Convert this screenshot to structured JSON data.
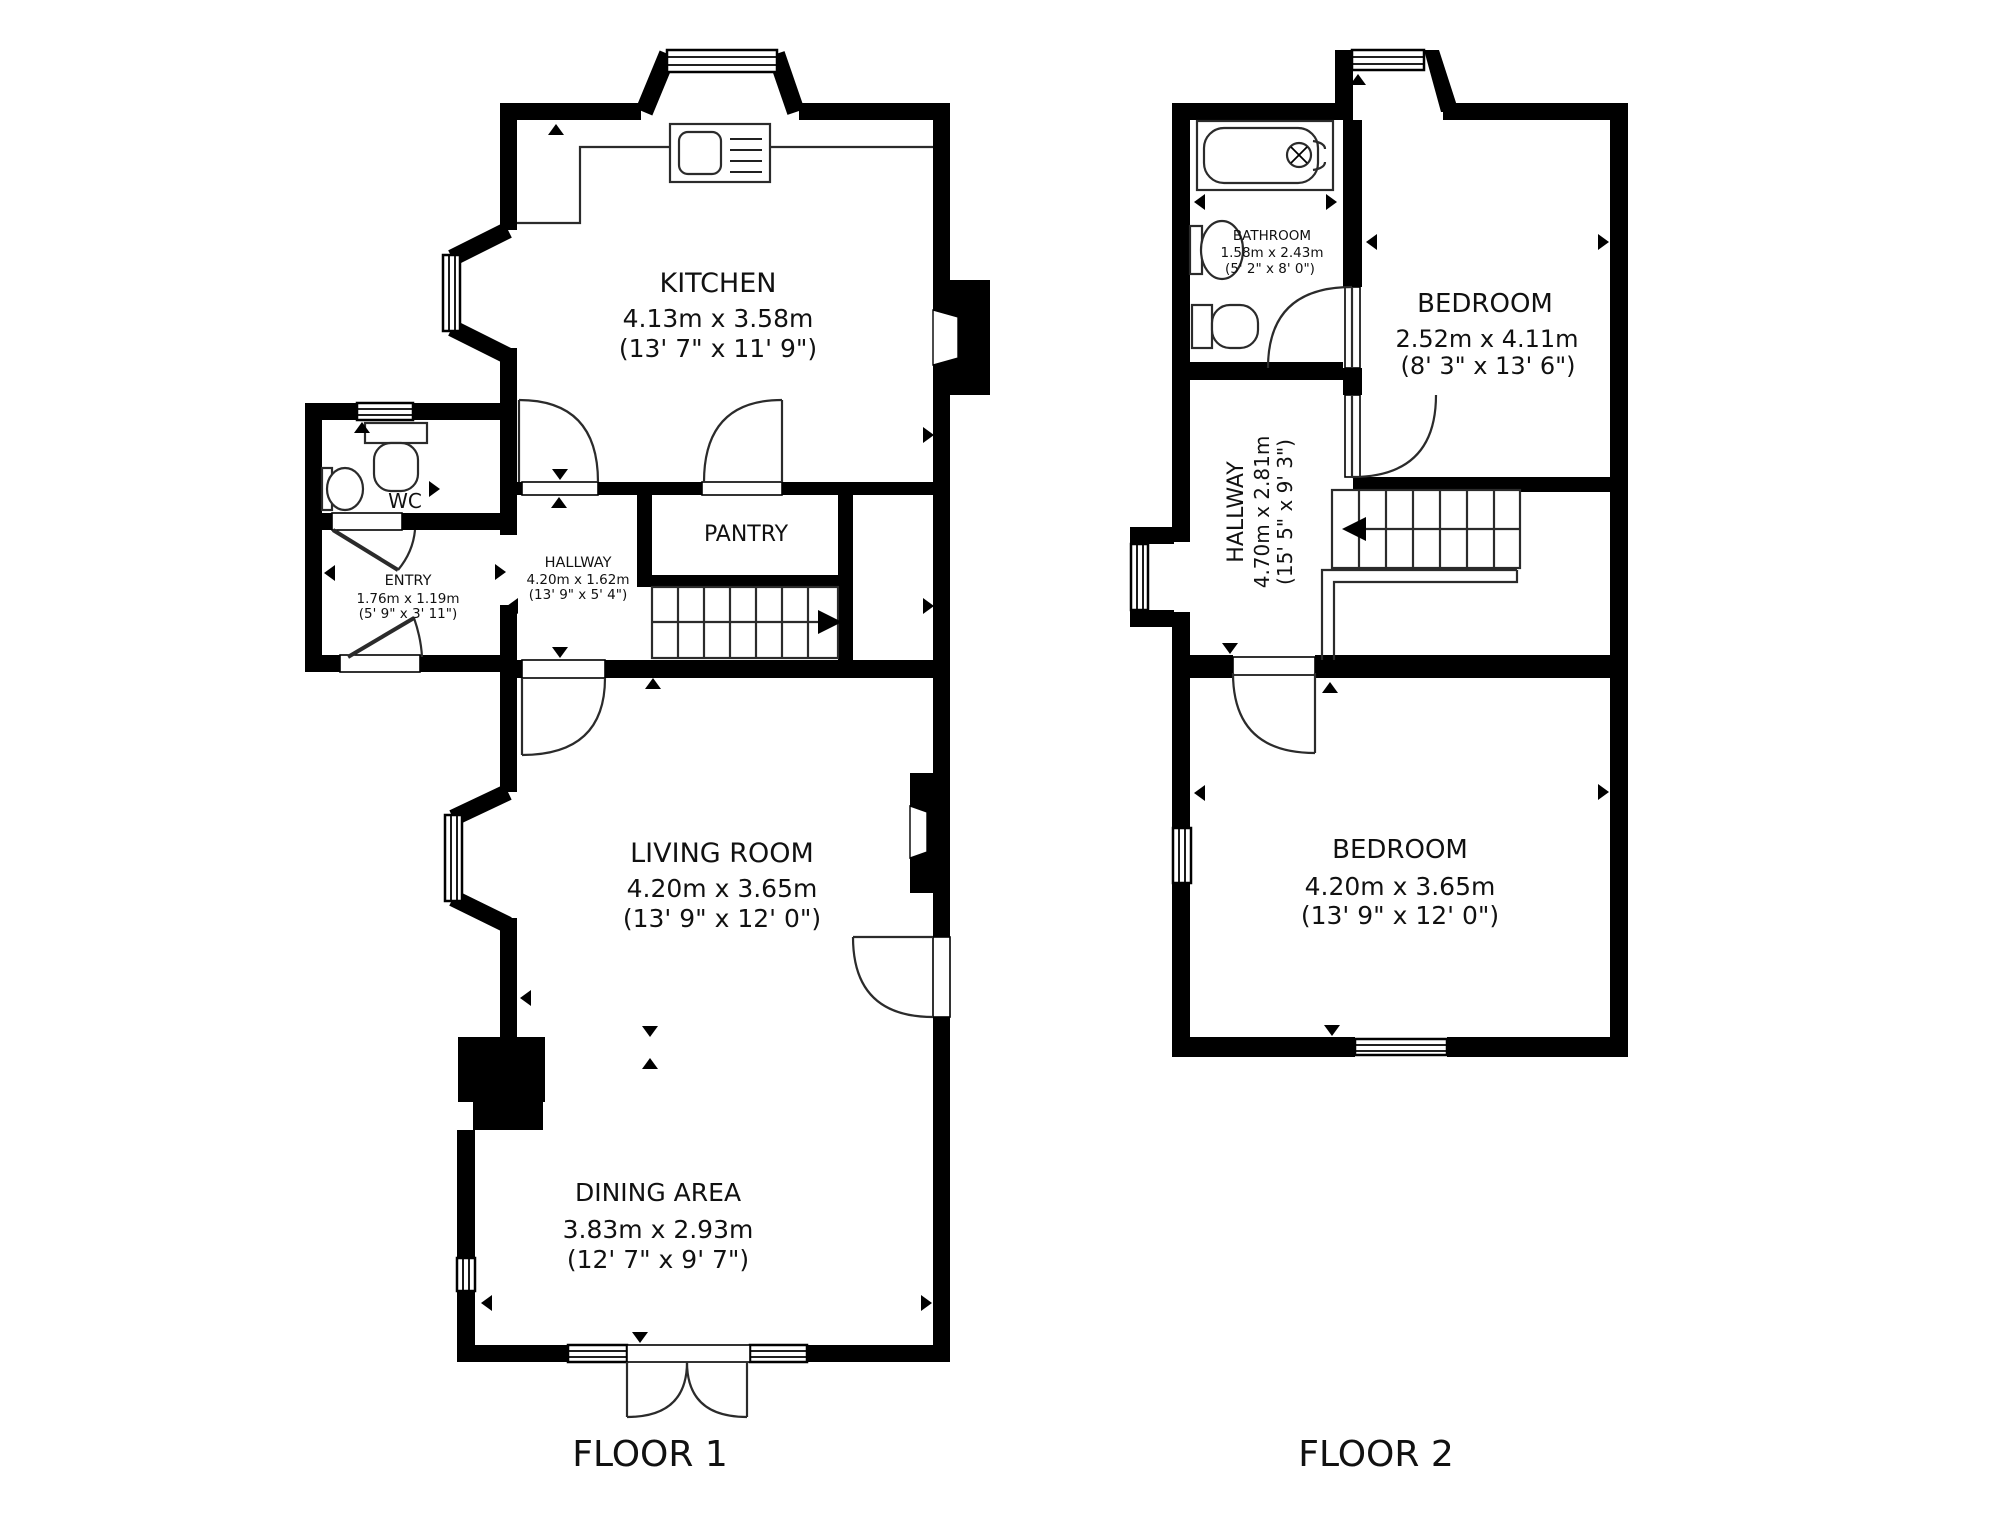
{
  "colors": {
    "wall": "#000000",
    "line": "#2b2b2b",
    "text": "#111111",
    "background": "#ffffff"
  },
  "floor1": {
    "caption": "FLOOR 1",
    "rooms": {
      "kitchen": {
        "name": "KITCHEN",
        "metric": "4.13m x 3.58m",
        "imperial": "(13' 7\" x 11' 9\")"
      },
      "wc": {
        "name": "WC"
      },
      "entry": {
        "name": "ENTRY",
        "metric": "1.76m x 1.19m",
        "imperial": "(5' 9\" x 3' 11\")"
      },
      "hallway": {
        "name": "HALLWAY",
        "metric": "4.20m x 1.62m",
        "imperial": "(13' 9\" x 5' 4\")"
      },
      "pantry": {
        "name": "PANTRY"
      },
      "living": {
        "name": "LIVING ROOM",
        "metric": "4.20m x 3.65m",
        "imperial": "(13' 9\" x 12' 0\")"
      },
      "dining": {
        "name": "DINING AREA",
        "metric": "3.83m x 2.93m",
        "imperial": "(12' 7\" x 9' 7\")"
      }
    }
  },
  "floor2": {
    "caption": "FLOOR 2",
    "rooms": {
      "bathroom": {
        "name": "BATHROOM",
        "metric": "1.58m x 2.43m",
        "imperial": "(5' 2\" x 8' 0\")"
      },
      "bedroom1": {
        "name": "BEDROOM",
        "metric": "2.52m x 4.11m",
        "imperial": "(8' 3\" x 13' 6\")"
      },
      "hallway": {
        "name": "HALLWAY",
        "metric": "4.70m x 2.81m",
        "imperial": "(15' 5\" x 9' 3\")"
      },
      "bedroom2": {
        "name": "BEDROOM",
        "metric": "4.20m x 3.65m",
        "imperial": "(13' 9\" x 12' 0\")"
      }
    }
  }
}
